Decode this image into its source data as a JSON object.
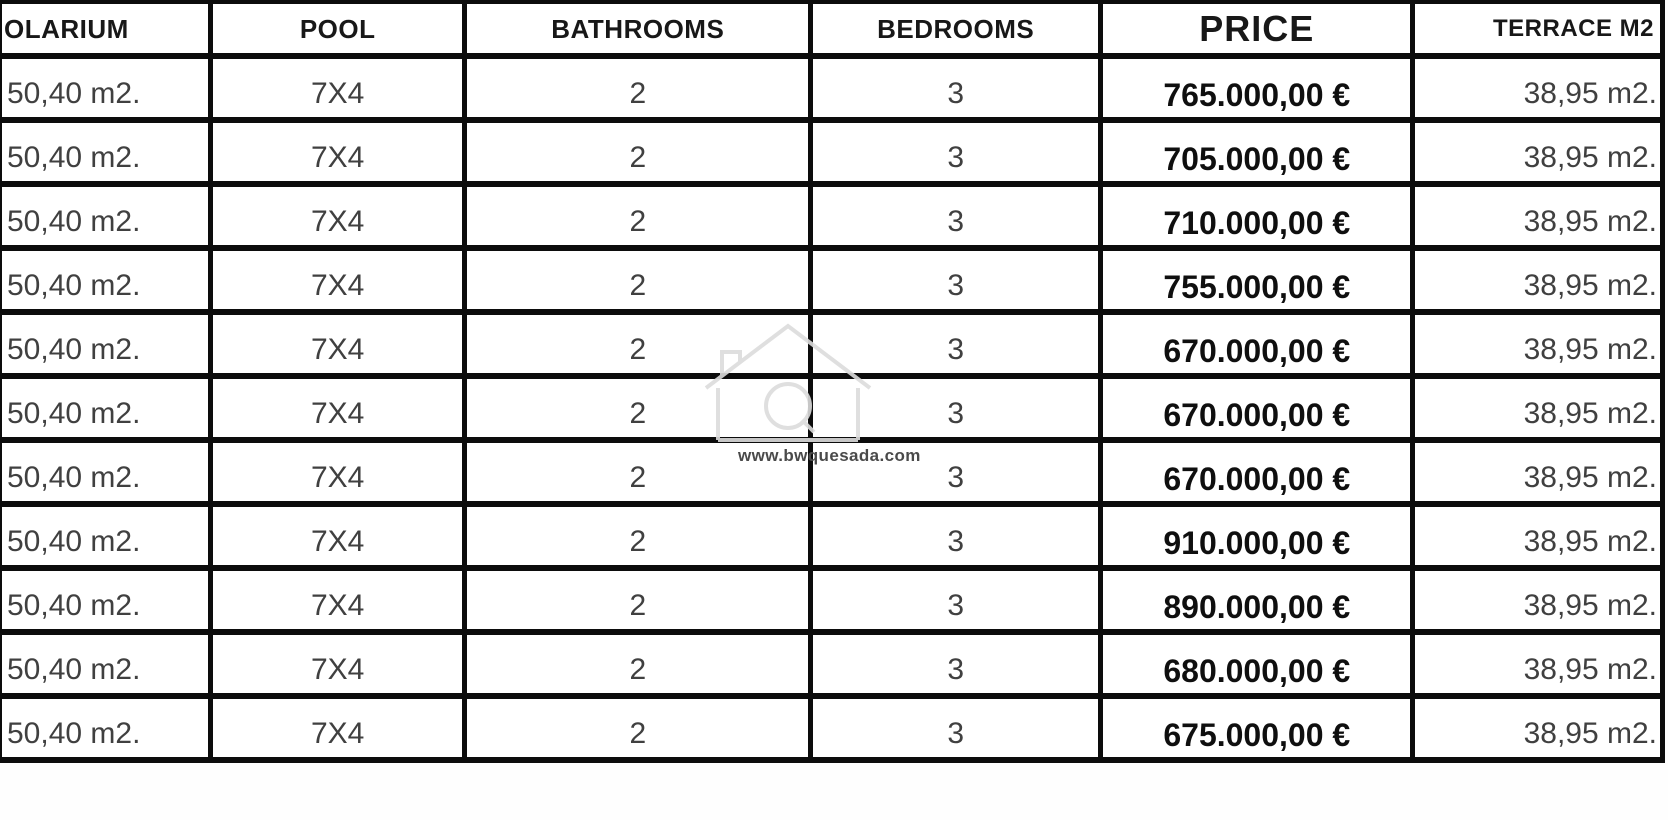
{
  "table": {
    "columns": [
      {
        "key": "solarium",
        "label": "OLARIUM"
      },
      {
        "key": "pool",
        "label": "POOL"
      },
      {
        "key": "bathrooms",
        "label": "BATHROOMS"
      },
      {
        "key": "bedrooms",
        "label": "BEDROOMS"
      },
      {
        "key": "price",
        "label": "PRICE"
      },
      {
        "key": "terrace",
        "label": "TERRACE M2"
      }
    ],
    "rows": [
      {
        "solarium": "50,40 m2.",
        "pool": "7X4",
        "bathrooms": "2",
        "bedrooms": "3",
        "price": "765.000,00 €",
        "terrace": "38,95 m2."
      },
      {
        "solarium": "50,40 m2.",
        "pool": "7X4",
        "bathrooms": "2",
        "bedrooms": "3",
        "price": "705.000,00 €",
        "terrace": "38,95 m2."
      },
      {
        "solarium": "50,40 m2.",
        "pool": "7X4",
        "bathrooms": "2",
        "bedrooms": "3",
        "price": "710.000,00 €",
        "terrace": "38,95 m2."
      },
      {
        "solarium": "50,40 m2.",
        "pool": "7X4",
        "bathrooms": "2",
        "bedrooms": "3",
        "price": "755.000,00 €",
        "terrace": "38,95 m2."
      },
      {
        "solarium": "50,40 m2.",
        "pool": "7X4",
        "bathrooms": "2",
        "bedrooms": "3",
        "price": "670.000,00 €",
        "terrace": "38,95 m2."
      },
      {
        "solarium": "50,40 m2.",
        "pool": "7X4",
        "bathrooms": "2",
        "bedrooms": "3",
        "price": "670.000,00 €",
        "terrace": "38,95 m2."
      },
      {
        "solarium": "50,40 m2.",
        "pool": "7X4",
        "bathrooms": "2",
        "bedrooms": "3",
        "price": "670.000,00 €",
        "terrace": "38,95 m2."
      },
      {
        "solarium": "50,40 m2.",
        "pool": "7X4",
        "bathrooms": "2",
        "bedrooms": "3",
        "price": "910.000,00 €",
        "terrace": "38,95 m2."
      },
      {
        "solarium": "50,40 m2.",
        "pool": "7X4",
        "bathrooms": "2",
        "bedrooms": "3",
        "price": "890.000,00 €",
        "terrace": "38,95 m2."
      },
      {
        "solarium": "50,40 m2.",
        "pool": "7X4",
        "bathrooms": "2",
        "bedrooms": "3",
        "price": "680.000,00 €",
        "terrace": "38,95 m2."
      },
      {
        "solarium": "50,40 m2.",
        "pool": "7X4",
        "bathrooms": "2",
        "bedrooms": "3",
        "price": "675.000,00 €",
        "terrace": "38,95 m2."
      }
    ]
  },
  "watermark": {
    "url_text": "www.bwquesada.com"
  },
  "colors": {
    "border": "#0c0c0c",
    "header_text": "#181818",
    "cell_text": "#404040",
    "price_text": "#0f0f0f",
    "watermark_text": "#4a4a4a",
    "watermark_outline": "#dcdcdc",
    "background": "#ffffff"
  }
}
